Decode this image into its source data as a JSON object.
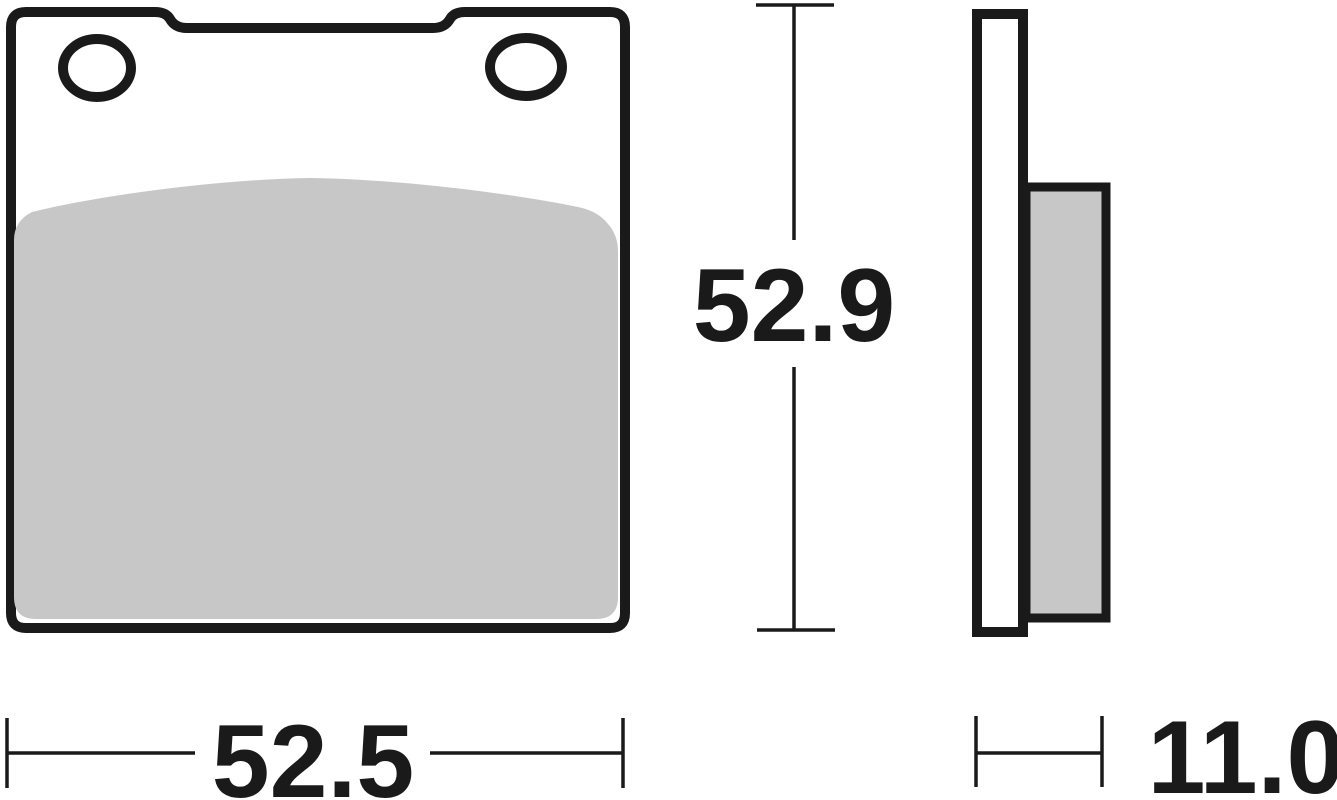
{
  "drawing": {
    "name": "brake-pad-technical-drawing",
    "dimensions": {
      "width": "52.5",
      "height": "52.9",
      "thickness": "11.0"
    },
    "colors": {
      "line": "#1a1a1a",
      "friction": "#c7c7c7",
      "background": "#ffffff"
    }
  }
}
